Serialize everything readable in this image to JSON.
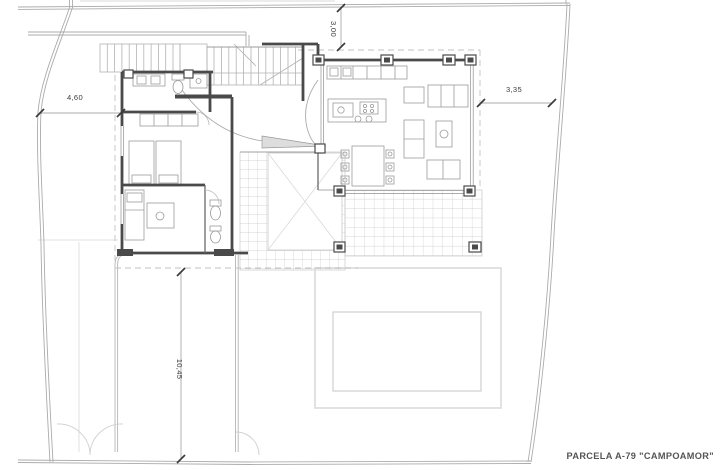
{
  "drawing": {
    "parcel_label": "PARCELA A-79 \"CAMPOAMOR\"",
    "dimensions": {
      "top": "3,00",
      "left": "4,60",
      "right": "3,35",
      "bottom": "10,45"
    },
    "colors": {
      "walls": "#4a4a4a",
      "furniture": "#9b9b9b",
      "boundary": "#ababab",
      "tile_grid": "#c9c9c9",
      "pool": "#d8d8d8",
      "dimension_text": "#3d3d3d",
      "background": "#ffffff"
    }
  }
}
